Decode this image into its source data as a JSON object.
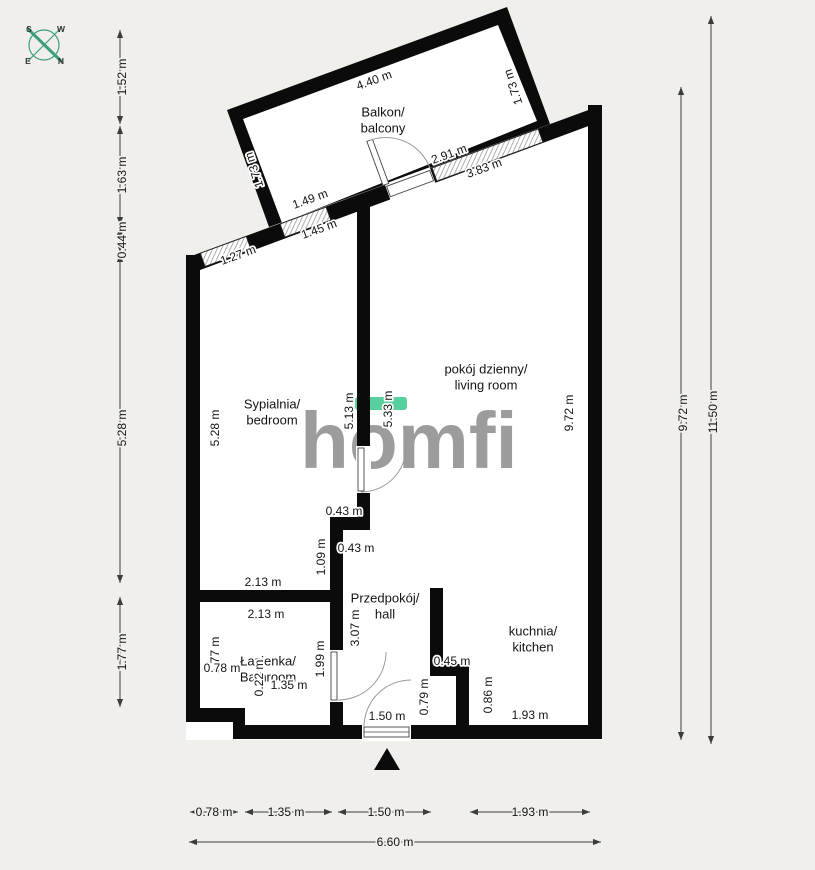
{
  "canvas": {
    "width": 815,
    "height": 870,
    "background": "#f0efeb"
  },
  "compass": {
    "color": "#3e9e7c",
    "letters": {
      "top_left": "S",
      "top_right": "W",
      "bottom_left": "E",
      "bottom_right": "N"
    }
  },
  "logo": {
    "text": "homfi",
    "color": "#9c9c9c",
    "accent_color": "#57cf9f"
  },
  "rooms": [
    {
      "id": "balcony",
      "line1": "Balkon/",
      "line2": "balcony",
      "x": 383,
      "y": 112
    },
    {
      "id": "bedroom",
      "line1": "Sypialnia/",
      "line2": "bedroom",
      "x": 272,
      "y": 404
    },
    {
      "id": "living-room",
      "line1": "pokój dzienny/",
      "line2": "living room",
      "x": 486,
      "y": 369
    },
    {
      "id": "hall",
      "line1": "Przedpokój/",
      "line2": "hall",
      "x": 385,
      "y": 598
    },
    {
      "id": "bathroom",
      "line1": "Łazienka/",
      "line2": "Bathroom",
      "x": 268,
      "y": 661
    },
    {
      "id": "kitchen",
      "line1": "kuchnia/",
      "line2": "kitchen",
      "x": 533,
      "y": 631
    }
  ],
  "dimension_labels": [
    {
      "t": "4.40 m",
      "x": 374,
      "y": 80,
      "r": -20
    },
    {
      "t": "1.49 m",
      "x": 310,
      "y": 199,
      "r": -20
    },
    {
      "t": "1.45 m",
      "x": 319,
      "y": 229,
      "r": -20
    },
    {
      "t": "1.27 m",
      "x": 238,
      "y": 255,
      "r": -20
    },
    {
      "t": "2.91 m",
      "x": 449,
      "y": 154,
      "r": -20
    },
    {
      "t": "3.83 m",
      "x": 484,
      "y": 168,
      "r": -20
    },
    {
      "t": "1.73 m",
      "x": 254,
      "y": 170,
      "r": -108
    },
    {
      "t": "1.73 m",
      "x": 513,
      "y": 87,
      "r": -108
    },
    {
      "t": "5.28 m",
      "x": 215,
      "y": 428,
      "r": -90
    },
    {
      "t": "5.13 m",
      "x": 349,
      "y": 411,
      "r": -90
    },
    {
      "t": "5.33 m",
      "x": 388,
      "y": 409,
      "r": -90
    },
    {
      "t": "9.72 m",
      "x": 569,
      "y": 413,
      "r": -90
    },
    {
      "t": "1.09 m",
      "x": 321,
      "y": 557,
      "r": -90
    },
    {
      "t": "3.07 m",
      "x": 355,
      "y": 628,
      "r": -90
    },
    {
      "t": "1.99 m",
      "x": 320,
      "y": 659,
      "r": -90
    },
    {
      "t": "1.77 m",
      "x": 215,
      "y": 655,
      "r": -90
    },
    {
      "t": "0.22 m",
      "x": 259,
      "y": 678,
      "r": -90
    },
    {
      "t": "0.79 m",
      "x": 424,
      "y": 697,
      "r": -90
    },
    {
      "t": "0.86 m",
      "x": 488,
      "y": 695,
      "r": -90
    },
    {
      "t": "0.43 m",
      "x": 344,
      "y": 511
    },
    {
      "t": "0.43 m",
      "x": 356,
      "y": 548
    },
    {
      "t": "2.13 m",
      "x": 263,
      "y": 582
    },
    {
      "t": "2.13 m",
      "x": 266,
      "y": 614
    },
    {
      "t": "0.78 m",
      "x": 222,
      "y": 668
    },
    {
      "t": "1.35 m",
      "x": 289,
      "y": 685
    },
    {
      "t": "1.50 m",
      "x": 387,
      "y": 716
    },
    {
      "t": "0.45 m",
      "x": 452,
      "y": 661
    },
    {
      "t": "1.93 m",
      "x": 530,
      "y": 715
    },
    {
      "t": "1.52 m",
      "x": 122,
      "y": 77,
      "r": -90,
      "h": "bg"
    },
    {
      "t": "1.63 m",
      "x": 122,
      "y": 175,
      "r": -90,
      "h": "bg"
    },
    {
      "t": "0.44 m",
      "x": 122,
      "y": 240,
      "r": -90,
      "h": "bg"
    },
    {
      "t": "5.28 m",
      "x": 122,
      "y": 428,
      "r": -90,
      "h": "bg"
    },
    {
      "t": "1.77 m",
      "x": 122,
      "y": 652,
      "r": -90,
      "h": "bg"
    },
    {
      "t": "9.72 m",
      "x": 683,
      "y": 413,
      "r": -90,
      "h": "bg"
    },
    {
      "t": "11.50 m",
      "x": 713,
      "y": 412,
      "r": -90,
      "h": "bg"
    },
    {
      "t": "0.78 m",
      "x": 214,
      "y": 812,
      "h": "bg"
    },
    {
      "t": "1.35 m",
      "x": 286,
      "y": 812,
      "h": "bg"
    },
    {
      "t": "1.50 m",
      "x": 386,
      "y": 812,
      "h": "bg"
    },
    {
      "t": "1.93 m",
      "x": 530,
      "y": 812,
      "h": "bg"
    },
    {
      "t": "6.60 m",
      "x": 395,
      "y": 842,
      "h": "bg"
    }
  ]
}
